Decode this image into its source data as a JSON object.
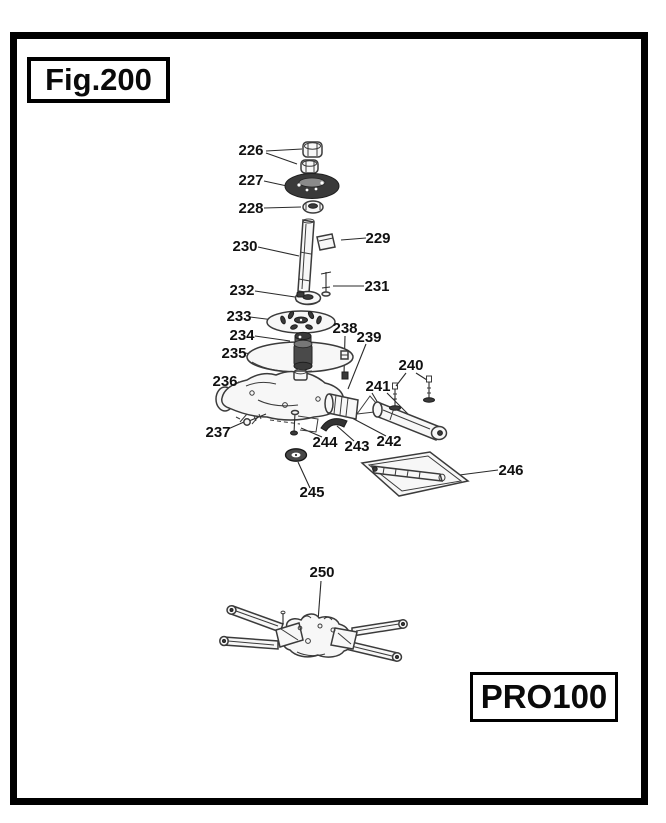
{
  "page": {
    "background": "#ffffff",
    "ink_color": "#3b3b3b",
    "border_color": "#000000"
  },
  "figure_box": {
    "label": "Fig.200"
  },
  "model_box": {
    "label": "PRO100"
  },
  "callouts": [
    {
      "label": "226",
      "shape": "hex-nuts"
    },
    {
      "label": "227",
      "shape": "pulley-gear"
    },
    {
      "label": "228",
      "shape": "flange-nut"
    },
    {
      "label": "229",
      "shape": "key"
    },
    {
      "label": "230",
      "shape": "vertical-shaft"
    },
    {
      "label": "231",
      "shape": "pin"
    },
    {
      "label": "232",
      "shape": "collar"
    },
    {
      "label": "233",
      "shape": "slotted-washer-disc"
    },
    {
      "label": "234",
      "shape": "bearing-hub"
    },
    {
      "label": "235",
      "shape": "guard-disc"
    },
    {
      "label": "236",
      "shape": "gear-housing"
    },
    {
      "label": "237",
      "shape": "bolt"
    },
    {
      "label": "238",
      "shape": "small-screw"
    },
    {
      "label": "239",
      "shape": "small-screw"
    },
    {
      "label": "240",
      "shape": "stud-screws"
    },
    {
      "label": "241",
      "shape": "axle-tube"
    },
    {
      "label": "242",
      "shape": "coupling"
    },
    {
      "label": "243",
      "shape": "lever"
    },
    {
      "label": "244",
      "shape": "bracket-pin"
    },
    {
      "label": "245",
      "shape": "seal-washer"
    },
    {
      "label": "246",
      "shape": "cover-plate"
    },
    {
      "label": "250",
      "shape": "rotor-assembly"
    }
  ]
}
